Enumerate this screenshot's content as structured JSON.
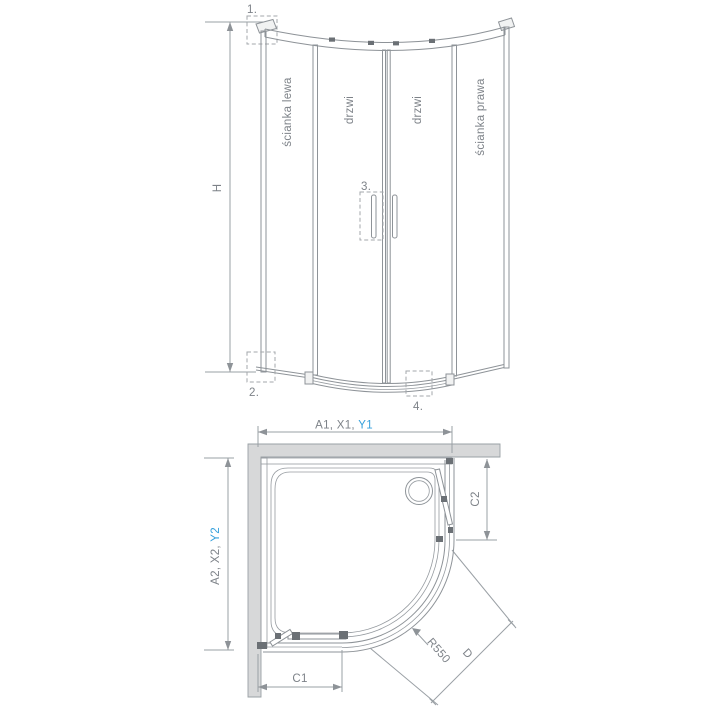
{
  "drawing_title": "quadrant-shower-enclosure-technical-drawing",
  "front_view": {
    "labels": {
      "left_wall": "ścianka lewa",
      "door_left": "drzwi",
      "door_right": "drzwi",
      "right_wall": "ścianka prawa"
    },
    "height_label": "H",
    "callouts": {
      "c1": "1.",
      "c2": "2.",
      "c3": "3.",
      "c4": "4."
    }
  },
  "plan_view": {
    "width_label_prefix": "A1, X1, ",
    "width_label_blue": "Y1",
    "depth_label_prefix": "A2, X2, ",
    "depth_label_blue": "Y2",
    "right_offset_label": "C2",
    "bottom_offset_label": "C1",
    "radius_label": "R550",
    "diagonal_label": "D"
  },
  "colors": {
    "accent_blue": "#35a0dc",
    "line_gray": "#8e9398",
    "text_gray": "#7d8288",
    "wall_fill": "#d7d8d9"
  }
}
